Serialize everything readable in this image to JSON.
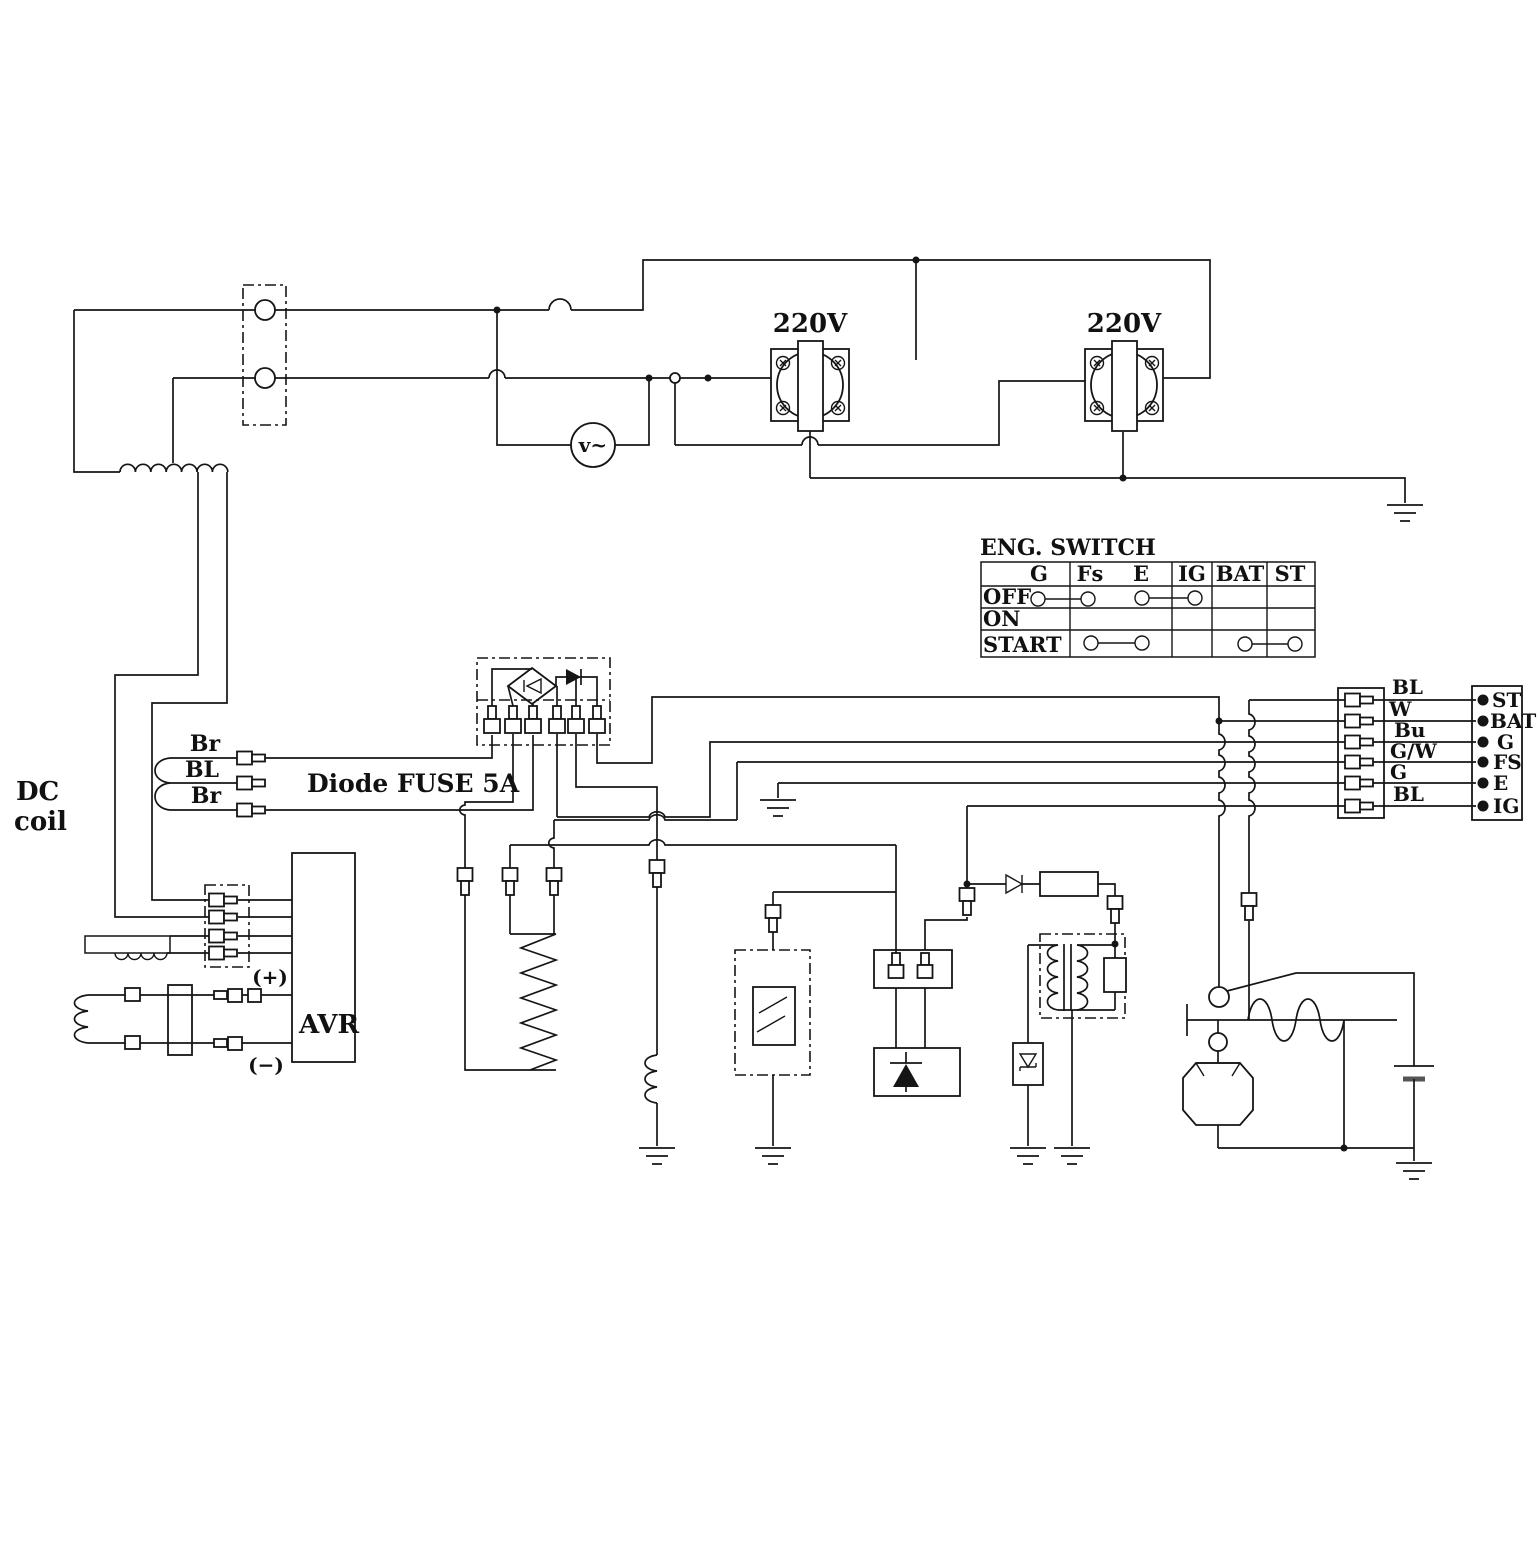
{
  "labels": {
    "dc_coil_line1": "DC",
    "dc_coil_line2": "coil",
    "diode_fuse_note": "Diode FUSE 5A",
    "avr": "AVR",
    "avr_positive": "(+)",
    "avr_negative": "(−)",
    "voltmeter": "v~",
    "outlet_left_voltage": "220V",
    "outlet_right_voltage": "220V"
  },
  "left_wires": [
    "Br",
    "BL",
    "Br"
  ],
  "eng_switch": {
    "title": "ENG. SWITCH",
    "columns": [
      "G",
      "Fs",
      "E",
      "IG",
      "BAT",
      "ST"
    ],
    "rows": [
      "OFF",
      "ON",
      "START"
    ],
    "connections": [
      {
        "row": "OFF",
        "from": "G",
        "to": "Fs"
      },
      {
        "row": "OFF",
        "from": "E",
        "to": "IG"
      },
      {
        "row": "START",
        "from": "Fs",
        "to": "E"
      },
      {
        "row": "START",
        "from": "BAT",
        "to": "ST"
      }
    ]
  },
  "harness_connector": {
    "wire_labels": [
      "BL",
      "W",
      "Bu",
      "G/W",
      "G",
      "BL"
    ],
    "terminals": [
      "ST",
      "BAT",
      "G",
      "FS",
      "E",
      "IG"
    ]
  }
}
